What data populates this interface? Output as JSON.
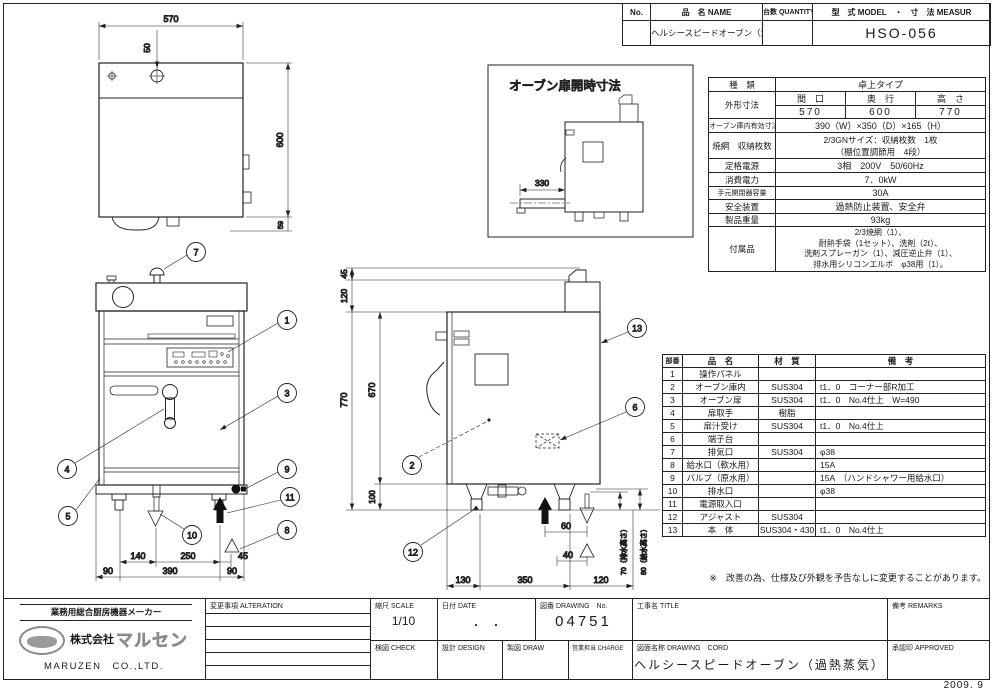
{
  "sheet": {
    "issue_date": "2009. 9",
    "note": "※　改善の為、仕様及び外観を予告なしに変更することがあります。"
  },
  "header": {
    "no_label": "No.",
    "name_label": "品　名 NAME",
    "qty_label": "台数 QUANTITY",
    "model_label": "型　式 MODEL　・　寸　法 MEASUR",
    "name_value": "ヘルシースピードオーブン（過熱水蒸気）",
    "model_value": "HSO-056"
  },
  "spec": {
    "type_label": "種　類",
    "type_value": "卓上タイプ",
    "outer_label": "外形寸法",
    "w_label": "間　口",
    "d_label": "奥　行",
    "h_label": "高　さ",
    "w_value": "570",
    "d_value": "600",
    "h_value": "770",
    "cavity_label": "オーブン庫内有効寸法",
    "cavity_value": "390（W）×350（D）×165（H）",
    "rack_label": "焼網　収納枚数",
    "rack_value1": "2/3GNサイズ：収納枚数　1枚",
    "rack_value2": "（棚位置調節用　4段）",
    "power_label": "定格電源",
    "power_value": "3相　200V　50/60Hz",
    "consumption_label": "消費電力",
    "consumption_value": "7．0kW",
    "breaker_label": "手元開閉器容量",
    "breaker_value": "30A",
    "safety_label": "安全装置",
    "safety_value": "過熱防止装置、安全弁",
    "weight_label": "製品重量",
    "weight_value": "93kg",
    "acc_label": "付属品",
    "acc_line1": "2/3焼網（1）、",
    "acc_line2": "耐熱手袋（1セット）、洗剤（2ℓ）、",
    "acc_line3": "洗剤スプレーガン（1）、減圧逆止弁（1）、",
    "acc_line4": "排水用シリコンエルボ　φ38用（1）。"
  },
  "parts": {
    "no_label": "部番",
    "name_label": "品　名",
    "material_label": "材　質",
    "remark_label": "備　考",
    "rows": [
      {
        "no": "1",
        "name": "操作パネル",
        "material": "",
        "remark": ""
      },
      {
        "no": "2",
        "name": "オーブン庫内",
        "material": "SUS304",
        "remark": "t1．0　コーナー部R加工"
      },
      {
        "no": "3",
        "name": "オーブン扉",
        "material": "SUS304",
        "remark": "t1．0　No.4仕上　W=490"
      },
      {
        "no": "4",
        "name": "扉取手",
        "material": "樹脂",
        "remark": ""
      },
      {
        "no": "5",
        "name": "扉汁受け",
        "material": "SUS304",
        "remark": "t1．0　No.4仕上"
      },
      {
        "no": "6",
        "name": "端子台",
        "material": "",
        "remark": ""
      },
      {
        "no": "7",
        "name": "排気口",
        "material": "SUS304",
        "remark": "φ38"
      },
      {
        "no": "8",
        "name": "給水口（軟水用）",
        "material": "",
        "remark": "15A"
      },
      {
        "no": "9",
        "name": "バルブ（原水用）",
        "material": "",
        "remark": "15A　（ハンドシャワー用給水口）"
      },
      {
        "no": "10",
        "name": "排水口",
        "material": "",
        "remark": "φ38"
      },
      {
        "no": "11",
        "name": "電源取入口",
        "material": "",
        "remark": ""
      },
      {
        "no": "12",
        "name": "アジャスト",
        "material": "SUS304",
        "remark": ""
      },
      {
        "no": "13",
        "name": "本　体",
        "material": "SUS304・430",
        "remark": "t1．0　No.4仕上"
      }
    ]
  },
  "title_block": {
    "alteration_label": "変更事項 ALTERATION",
    "scale_label": "縮尺 SCALE",
    "scale_value": "1/10",
    "date_label": "日付 DATE",
    "date_value": "・　・",
    "drawing_no_label": "図番 DRAWING　No.",
    "drawing_no_value": "04751",
    "title_label": "工事名 TITLE",
    "remarks_label": "備考 REMARKS",
    "check_label": "検図 CHECK",
    "design_label": "設計 DESIGN",
    "draw_label": "製図 DRAW",
    "charge_label": "営業担当 CHARGE",
    "drawing_name_label": "図面名称 DRAWING　CORD",
    "drawing_name_value": "ヘルシースピードオーブン（過熱蒸気）",
    "approved_label": "承認印 APPROVED"
  },
  "company": {
    "tagline": "業務用総合厨房機器メーカー",
    "name_prefix": "株式会社",
    "name_brand": "マルセン",
    "name_en": "MARUZEN　CO.,LTD."
  },
  "drawings": {
    "inset_title": "オーブン扉開時寸法",
    "balloons": [
      "1",
      "2",
      "3",
      "4",
      "5",
      "6",
      "7",
      "8",
      "9",
      "10",
      "11",
      "12",
      "13"
    ],
    "dims": {
      "tv_w": "570",
      "tv_hole": "50",
      "tv_d": "600",
      "tv_back": "59",
      "fv_140": "140",
      "fv_250": "250",
      "fv_45": "45",
      "fv_90l": "90",
      "fv_390": "390",
      "fv_90r": "90",
      "sv_45": "45",
      "sv_120": "120",
      "sv_770": "770",
      "sv_670": "670",
      "sv_100": "100",
      "sv_60": "60",
      "sv_40": "40",
      "sv_130": "130",
      "sv_350": "350",
      "sv_120b": "120",
      "sv_drain": "70（排水高さ）",
      "sv_supply": "80（給水高さ）",
      "inset_330": "330"
    }
  }
}
